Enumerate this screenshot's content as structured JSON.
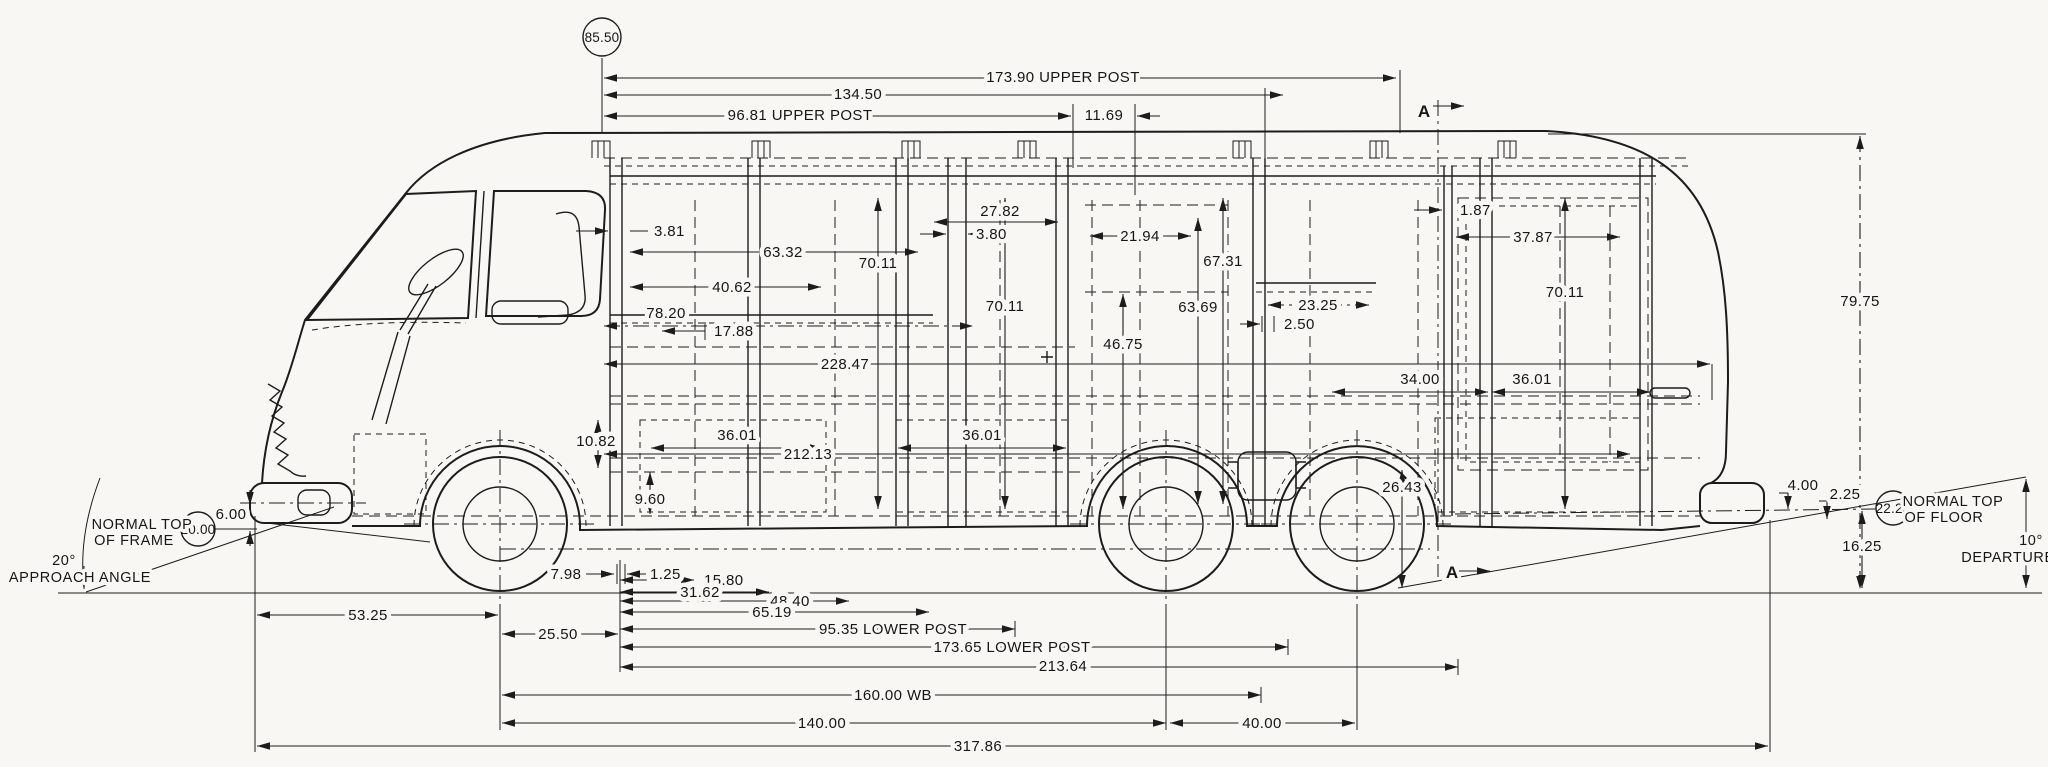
{
  "colors": {
    "ink": "#1c1c1c",
    "paper": "#f8f7f3"
  },
  "callouts": {
    "overall_height": "85.50",
    "frame_datum": "20.00",
    "floor_datum": "22.25"
  },
  "section": {
    "marker": "A"
  },
  "notes": {
    "frame_line1": "NORMAL TOP",
    "frame_line2": "OF FRAME",
    "approach_deg": "20°",
    "approach_label": "APPROACH ANGLE",
    "floor_line1": "NORMAL TOP",
    "floor_line2": "OF FLOOR",
    "departure_deg": "10°",
    "departure_label": "DEPARTURE"
  },
  "dims": {
    "upper_post_173": "173.90 UPPER POST",
    "d134_50": "134.50",
    "upper_post_96": "96.81 UPPER POST",
    "d11_69": "11.69",
    "d3_81": "3.81",
    "d63_32": "63.32",
    "d40_62": "40.62",
    "d78_20": "78.20",
    "d17_88": "17.88",
    "d27_82": "27.82",
    "d3_80": "3.80",
    "d21_94": "21.94",
    "d67_31": "67.31",
    "d63_69": "63.69",
    "d46_75": "46.75",
    "d70_11_a": "70.11",
    "d70_11_b": "70.11",
    "d70_11_c": "70.11",
    "d23_25": "23.25",
    "d2_50": "2.50",
    "d1_87": "1.87",
    "d37_87": "37.87",
    "d228_47": "228.47",
    "d34_00": "34.00",
    "d36_01_left": "36.01",
    "d36_01_mid": "36.01",
    "d36_01_right": "36.01",
    "d212_13": "212.13",
    "d10_82": "10.82",
    "d9_60": "9.60",
    "d26_43": "26.43",
    "d79_75": "79.75",
    "d7_98": "7.98",
    "d1_25": "1.25",
    "d15_80": "15.80",
    "d31_62": "31.62",
    "d48_40": "48.40",
    "d65_19": "65.19",
    "d53_25": "53.25",
    "d25_50": "25.50",
    "lower_post_95": "95.35 LOWER POST",
    "lower_post_173": "173.65 LOWER POST",
    "d213_64": "213.64",
    "wheelbase": "160.00 WB",
    "d140_00": "140.00",
    "d40_00": "40.00",
    "overall_length": "317.86",
    "d6_00": "6.00",
    "d4_00": "4.00",
    "d2_25": "2.25",
    "d16_25": "16.25"
  }
}
